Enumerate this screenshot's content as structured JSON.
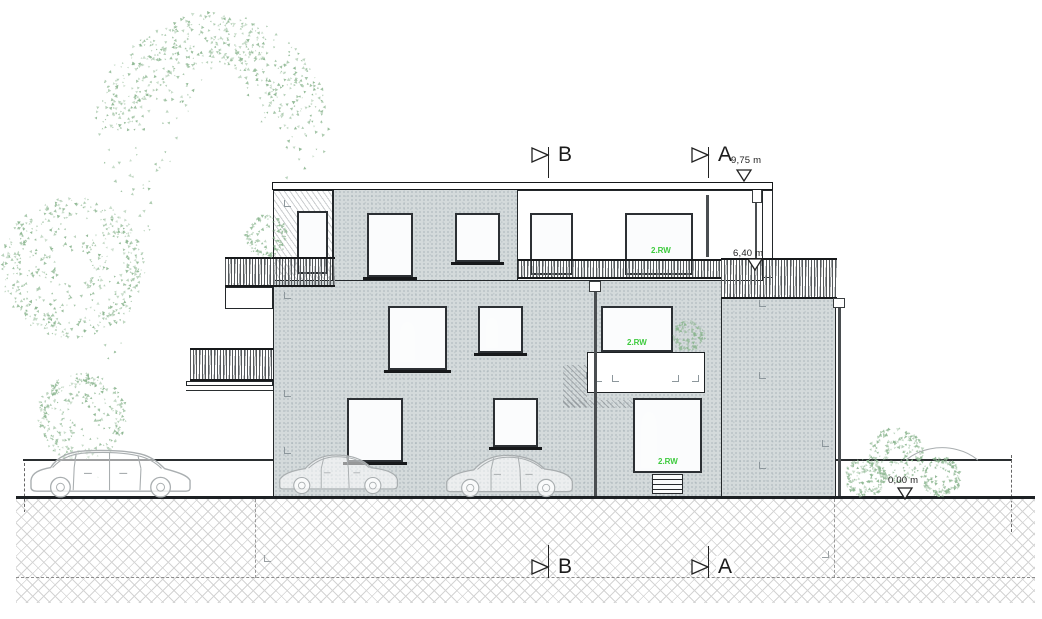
{
  "markers": {
    "section_top_b": "B",
    "section_top_a": "A",
    "section_bottom_b": "B",
    "section_bottom_a": "A"
  },
  "elevations": {
    "roof": "9,75 m",
    "upper_floor": "6,40 m",
    "ground": "0,00 m"
  },
  "windows": {
    "top_floor_label": "2.RW",
    "mid_floor_label": "2.RW",
    "ground_floor_label": "2.RW"
  },
  "colors": {
    "facade": "#d4dadb",
    "glass_light": "#d8e1ea",
    "glass_dark": "#8fa4bc",
    "tree": "#8cb690",
    "rw_label": "#3fcb3f",
    "line": "#1c2022",
    "hatch": "#d4d4d4",
    "car": "#a9aeb0"
  }
}
